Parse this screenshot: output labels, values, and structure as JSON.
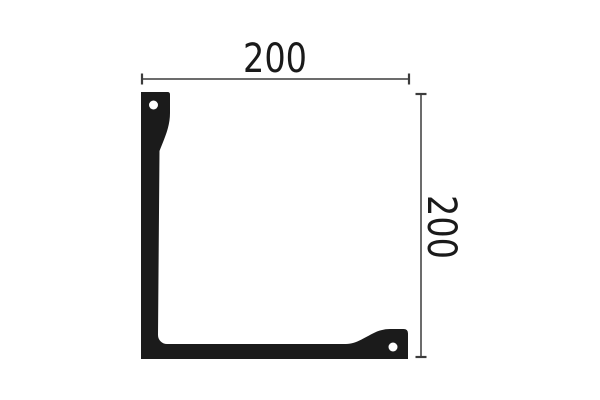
{
  "drawing": {
    "dimensions": {
      "width": {
        "label": "200"
      },
      "height": {
        "label": "200"
      }
    },
    "colors": {
      "profile": "#1b1b1b",
      "dimension_line": "#3c3c3c",
      "text": "#1a1a1a",
      "hole": "#ffffff",
      "background": "#ffffff"
    }
  }
}
